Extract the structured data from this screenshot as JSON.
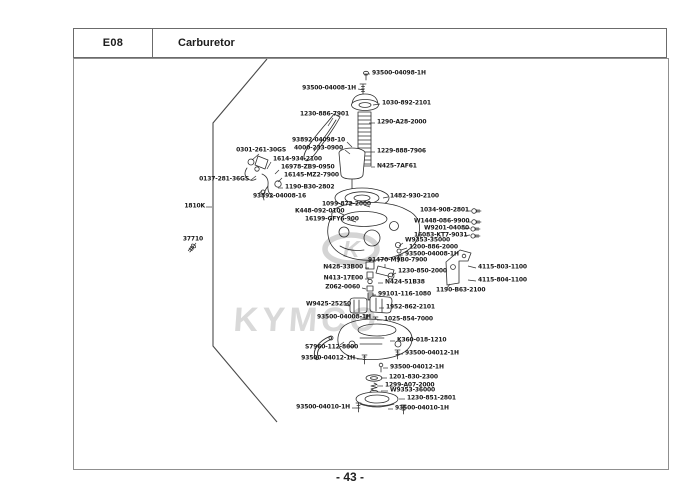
{
  "header": {
    "code": "E08",
    "title": "Carburetor"
  },
  "footer": {
    "page": "- 43 -"
  },
  "watermark": {
    "brand": "KYMCO",
    "emblem_letter": "K",
    "color": "#d8d8d8"
  },
  "diagram": {
    "description": "Exploded parts view of carburetor assembly",
    "labels": [
      {
        "text": "93500-04098-1H",
        "x": 372,
        "y": 74,
        "anchor": "left",
        "line": [
          370,
          74,
          364,
          74
        ]
      },
      {
        "text": "93500-04008-1H",
        "x": 356,
        "y": 89,
        "anchor": "right",
        "line": [
          358,
          89,
          364,
          90
        ]
      },
      {
        "text": "1030-892-2101",
        "x": 382,
        "y": 104,
        "anchor": "left",
        "line": [
          380,
          104,
          373,
          105
        ]
      },
      {
        "text": "1230-886-7901",
        "x": 349,
        "y": 115,
        "anchor": "right",
        "line": [
          333,
          118,
          328,
          126
        ]
      },
      {
        "text": "1290-A28-2000",
        "x": 377,
        "y": 123,
        "anchor": "left",
        "line": [
          375,
          123,
          369,
          123
        ]
      },
      {
        "text": "93892-04098-10",
        "x": 345,
        "y": 141,
        "anchor": "right",
        "line": [
          347,
          142,
          352,
          147
        ]
      },
      {
        "text": "4000-233-0900",
        "x": 343,
        "y": 149,
        "anchor": "right",
        "line": [
          345,
          150,
          350,
          154
        ]
      },
      {
        "text": "0301-261-30GS",
        "x": 286,
        "y": 151,
        "anchor": "right",
        "line": [
          259,
          154,
          252,
          160
        ]
      },
      {
        "text": "1614-934-2100",
        "x": 273,
        "y": 160,
        "anchor": "left",
        "line": [
          271,
          162,
          267,
          169
        ]
      },
      {
        "text": "16978-ZB9-0950",
        "x": 281,
        "y": 168,
        "anchor": "left",
        "line": [
          279,
          170,
          275,
          174
        ]
      },
      {
        "text": "16145-MZ2-7900",
        "x": 284,
        "y": 176,
        "anchor": "left",
        "line": [
          282,
          178,
          278,
          182
        ]
      },
      {
        "text": "0137-281-36GS",
        "x": 249,
        "y": 180,
        "anchor": "right",
        "line": [
          251,
          180,
          256,
          176
        ]
      },
      {
        "text": "1190-B30-2802",
        "x": 285,
        "y": 188,
        "anchor": "left",
        "line": [
          283,
          188,
          278,
          188
        ]
      },
      {
        "text": "93892-04008-16",
        "x": 253,
        "y": 197,
        "anchor": "left",
        "line": [
          258,
          194,
          262,
          191
        ]
      },
      {
        "text": "1229-888-7906",
        "x": 377,
        "y": 152,
        "anchor": "left",
        "line": [
          375,
          152,
          371,
          152
        ]
      },
      {
        "text": "N425-7AF61",
        "x": 377,
        "y": 167,
        "anchor": "left",
        "line": [
          375,
          167,
          371,
          167
        ]
      },
      {
        "text": "1810K",
        "x": 205,
        "y": 207,
        "anchor": "right",
        "line": [
          206,
          207,
          212,
          207
        ]
      },
      {
        "text": "1482-930-2100",
        "x": 390,
        "y": 197,
        "anchor": "left",
        "line": [
          388,
          197,
          383,
          198
        ]
      },
      {
        "text": "1099-872-2000",
        "x": 322,
        "y": 205,
        "anchor": "left",
        "line": [
          364,
          205,
          370,
          207
        ]
      },
      {
        "text": "K448-092-0100",
        "x": 295,
        "y": 212,
        "anchor": "left",
        "line": [
          338,
          212,
          344,
          215
        ]
      },
      {
        "text": "16199-GFY6-900",
        "x": 305,
        "y": 220,
        "anchor": "left",
        "line": [
          350,
          220,
          356,
          222
        ]
      },
      {
        "text": "1034-908-2801",
        "x": 420,
        "y": 211,
        "anchor": "left",
        "line": [
          466,
          211,
          471,
          211
        ]
      },
      {
        "text": "W1448-086-9900",
        "x": 414,
        "y": 222,
        "anchor": "left",
        "line": [
          466,
          222,
          471,
          222
        ]
      },
      {
        "text": "W9201-04080",
        "x": 424,
        "y": 229,
        "anchor": "left",
        "line": [
          464,
          229,
          470,
          228
        ]
      },
      {
        "text": "16083-KT7-9031",
        "x": 414,
        "y": 236,
        "anchor": "left",
        "line": [
          464,
          236,
          470,
          235
        ]
      },
      {
        "text": "W9353-35000",
        "x": 405,
        "y": 241,
        "anchor": "left",
        "line": [
          403,
          243,
          399,
          246
        ]
      },
      {
        "text": "1200-886-2000",
        "x": 409,
        "y": 248,
        "anchor": "left",
        "line": [
          407,
          248,
          401,
          250
        ]
      },
      {
        "text": "93500-04008-1H",
        "x": 405,
        "y": 255,
        "anchor": "left",
        "line": [
          403,
          255,
          398,
          255
        ]
      },
      {
        "text": "91470-M9B0-7900",
        "x": 368,
        "y": 261,
        "anchor": "left",
        "line": [
          385,
          264,
          385,
          268
        ]
      },
      {
        "text": "1230-850-2000",
        "x": 398,
        "y": 272,
        "anchor": "left",
        "line": [
          396,
          273,
          392,
          275
        ]
      },
      {
        "text": "N428-33B00",
        "x": 363,
        "y": 268,
        "anchor": "right",
        "line": [
          365,
          268,
          369,
          268
        ]
      },
      {
        "text": "N413-17E00",
        "x": 363,
        "y": 279,
        "anchor": "right",
        "line": [
          365,
          279,
          369,
          279
        ]
      },
      {
        "text": "N424-51B38",
        "x": 385,
        "y": 283,
        "anchor": "left",
        "line": [
          383,
          283,
          378,
          283
        ]
      },
      {
        "text": "Z062-0060",
        "x": 360,
        "y": 288,
        "anchor": "right",
        "line": [
          362,
          288,
          366,
          289
        ]
      },
      {
        "text": "99101-116-1080",
        "x": 378,
        "y": 295,
        "anchor": "left",
        "line": [
          376,
          295,
          372,
          295
        ]
      },
      {
        "text": "4115-803-1100",
        "x": 478,
        "y": 268,
        "anchor": "left",
        "line": [
          476,
          268,
          468,
          266
        ]
      },
      {
        "text": "4115-804-1100",
        "x": 478,
        "y": 281,
        "anchor": "left",
        "line": [
          476,
          281,
          468,
          280
        ]
      },
      {
        "text": "1190-B63-2100",
        "x": 436,
        "y": 291,
        "anchor": "left",
        "line": [
          447,
          288,
          450,
          284
        ]
      },
      {
        "text": "W9425-25250",
        "x": 306,
        "y": 305,
        "anchor": "left",
        "line": [
          344,
          305,
          350,
          306
        ]
      },
      {
        "text": "1952-862-2101",
        "x": 386,
        "y": 308,
        "anchor": "left",
        "line": [
          384,
          308,
          379,
          308
        ]
      },
      {
        "text": "93500-04008-1H",
        "x": 317,
        "y": 318,
        "anchor": "left",
        "line": [
          360,
          318,
          365,
          318
        ]
      },
      {
        "text": "1025-854-7000",
        "x": 384,
        "y": 320,
        "anchor": "left",
        "line": [
          382,
          320,
          377,
          320
        ]
      },
      {
        "text": "S7960-112-8600",
        "x": 305,
        "y": 348,
        "anchor": "left",
        "line": [
          340,
          345,
          344,
          342
        ]
      },
      {
        "text": "K360-018-1210",
        "x": 397,
        "y": 341,
        "anchor": "left",
        "line": [
          395,
          341,
          390,
          341
        ]
      },
      {
        "text": "93500-04012-1H",
        "x": 355,
        "y": 359,
        "anchor": "right",
        "line": [
          357,
          359,
          362,
          359
        ]
      },
      {
        "text": "93500-04012-1H",
        "x": 405,
        "y": 354,
        "anchor": "left",
        "line": [
          403,
          354,
          398,
          354
        ]
      },
      {
        "text": "93500-04012-1H",
        "x": 390,
        "y": 368,
        "anchor": "left",
        "line": [
          388,
          368,
          383,
          368
        ]
      },
      {
        "text": "1201-830-2300",
        "x": 389,
        "y": 378,
        "anchor": "left",
        "line": [
          387,
          378,
          381,
          378
        ]
      },
      {
        "text": "1299-A07-2000",
        "x": 385,
        "y": 386,
        "anchor": "left",
        "line": [
          383,
          386,
          377,
          386
        ]
      },
      {
        "text": "W9353-36000",
        "x": 390,
        "y": 391,
        "anchor": "left",
        "line": [
          388,
          391,
          381,
          391
        ]
      },
      {
        "text": "1230-851-2801",
        "x": 407,
        "y": 399,
        "anchor": "left",
        "line": [
          405,
          399,
          399,
          399
        ]
      },
      {
        "text": "93500-04010-1H",
        "x": 350,
        "y": 408,
        "anchor": "right",
        "line": [
          352,
          408,
          357,
          408
        ]
      },
      {
        "text": "93500-04010-1H",
        "x": 395,
        "y": 409,
        "anchor": "left",
        "line": [
          393,
          409,
          388,
          409
        ]
      },
      {
        "text": "37710",
        "x": 203,
        "y": 240,
        "anchor": "right",
        "line": [
          196,
          243,
          193,
          247
        ]
      }
    ]
  }
}
